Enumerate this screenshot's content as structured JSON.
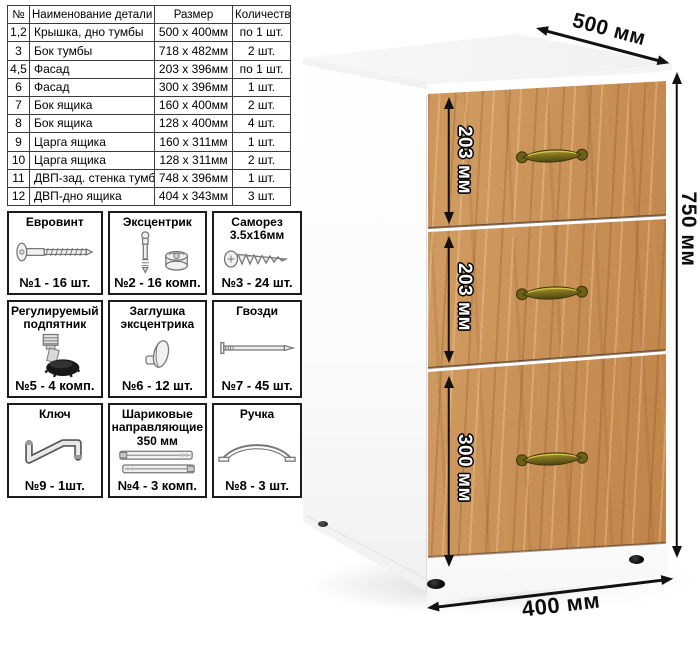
{
  "parts_table": {
    "headers": [
      "№",
      "Наименование детали",
      "Размер",
      "Количество"
    ],
    "rows": [
      [
        "1,2",
        "Крышка, дно тумбы",
        "500 x 400мм",
        "по 1 шт."
      ],
      [
        "3",
        "Бок тумбы",
        "718 x 482мм",
        "2 шт."
      ],
      [
        "4,5",
        "Фасад",
        "203 x 396мм",
        "по 1 шт."
      ],
      [
        "6",
        "Фасад",
        "300 x 396мм",
        "1 шт."
      ],
      [
        "7",
        "Бок ящика",
        "160 x 400мм",
        "2 шт."
      ],
      [
        "8",
        "Бок ящика",
        "128 x 400мм",
        "4 шт."
      ],
      [
        "9",
        "Царга ящика",
        "160 x 311мм",
        "1 шт."
      ],
      [
        "10",
        "Царга ящика",
        "128 x 311мм",
        "2 шт."
      ],
      [
        "11",
        "ДВП-зад. стенка тумбы",
        "748 x 396мм",
        "1 шт."
      ],
      [
        "12",
        "ДВП-дно ящика",
        "404 x 343мм",
        "3 шт."
      ]
    ]
  },
  "hardware": [
    {
      "name": "Евровинт",
      "count": "№1 - 16 шт.",
      "icon": "euro-screw"
    },
    {
      "name": "Эксцентрик",
      "count": "№2 - 16 комп.",
      "icon": "eccentric-cam"
    },
    {
      "name": "Саморез 3.5х16мм",
      "count": "№3 - 24 шт.",
      "icon": "self-tapping-screw"
    },
    {
      "name": "Регулируемый подпятник",
      "count": "№5 - 4 комп.",
      "icon": "adjustable-foot"
    },
    {
      "name": "Заглушка эксцентрика",
      "count": "№6 - 12 шт.",
      "icon": "cam-cap"
    },
    {
      "name": "Гвозди",
      "count": "№7 - 45 шт.",
      "icon": "nail"
    },
    {
      "name": "Ключ",
      "count": "№9 - 1шт.",
      "icon": "hex-key"
    },
    {
      "name": "Шариковые направляющие 350 мм",
      "count": "№4 - 3 комп.",
      "icon": "ball-bearing-slides"
    },
    {
      "name": "Ручка",
      "count": "№8 - 3 шт.",
      "icon": "handle"
    }
  ],
  "dimensions": {
    "depth_label": "500 мм",
    "height_label": "750 мм",
    "width_label": "400 мм",
    "drawer_labels": [
      "203 мм",
      "203 мм",
      "300 мм"
    ]
  },
  "colors": {
    "wood": "#c98e55",
    "wood_dark": "#8a5a2a",
    "handle_brass": "#8f7d22",
    "arrow_black": "#111111",
    "cabinet_white": "#ffffff"
  }
}
